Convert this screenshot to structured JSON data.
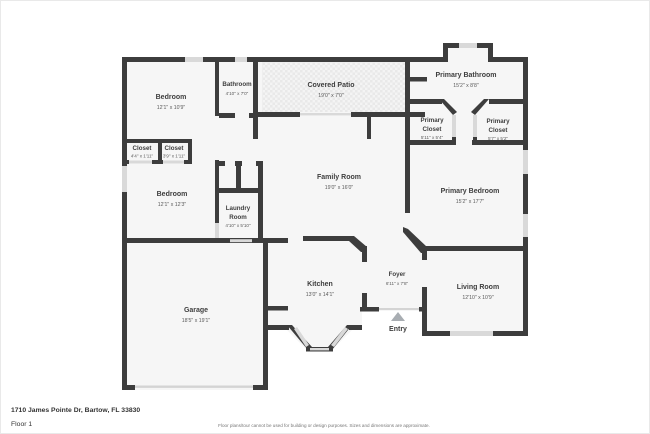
{
  "address": "1710 James Pointe Dr, Bartow, FL 33830",
  "floor_label": "Floor 1",
  "disclaimer": "Floor plans/tour cannot be used for building or design purposes. Sizes and dimensions are approximate.",
  "entry": {
    "label": "Entry",
    "arrow_icon": "triangle-up"
  },
  "colors": {
    "wall": "#3d3d3d",
    "room_fill": "#f6f6f6",
    "window": "#d9d9d9",
    "patio_dot": "#e9e9e9",
    "label_text": "#3e3e3e",
    "dims_text": "#5a5a5a",
    "entry_arrow": "#a8adb2"
  },
  "rooms": {
    "bedroom1": {
      "name": "Bedroom",
      "dims": "12'1\" x 10'9\""
    },
    "bathroom": {
      "name": "Bathroom",
      "dims": "4'10\" x 7'0\""
    },
    "covered_patio": {
      "name": "Covered Patio",
      "dims": "19'0\" x 7'0\""
    },
    "primary_bathroom": {
      "name": "Primary Bathroom",
      "dims": "15'2\" x 8'8\""
    },
    "primary_closet_left": {
      "name1": "Primary",
      "name2": "Closet",
      "dims": "5'11\" x 5'4\""
    },
    "primary_closet_right": {
      "name1": "Primary",
      "name2": "Closet",
      "dims": "5'7\" x 5'2\""
    },
    "closet_left": {
      "name": "Closet",
      "dims": "4'4\" x 1'11\""
    },
    "closet_right": {
      "name": "Closet",
      "dims": "3'9\" x 1'11\""
    },
    "bedroom2": {
      "name": "Bedroom",
      "dims": "12'1\" x 12'3\""
    },
    "family_room": {
      "name": "Family Room",
      "dims": "19'0\" x 16'0\""
    },
    "laundry": {
      "name1": "Laundry",
      "name2": "Room",
      "dims": "4'10\" x 5'10\""
    },
    "primary_bedroom": {
      "name": "Primary Bedroom",
      "dims": "15'2\" x 17'7\""
    },
    "kitchen": {
      "name": "Kitchen",
      "dims": "13'0\" x 14'1\""
    },
    "foyer": {
      "name": "Foyer",
      "dims": "6'11\" x 7'8\""
    },
    "living_room": {
      "name": "Living Room",
      "dims": "12'10\" x 10'9\""
    },
    "garage": {
      "name": "Garage",
      "dims": "18'5\" x 19'1\""
    }
  }
}
